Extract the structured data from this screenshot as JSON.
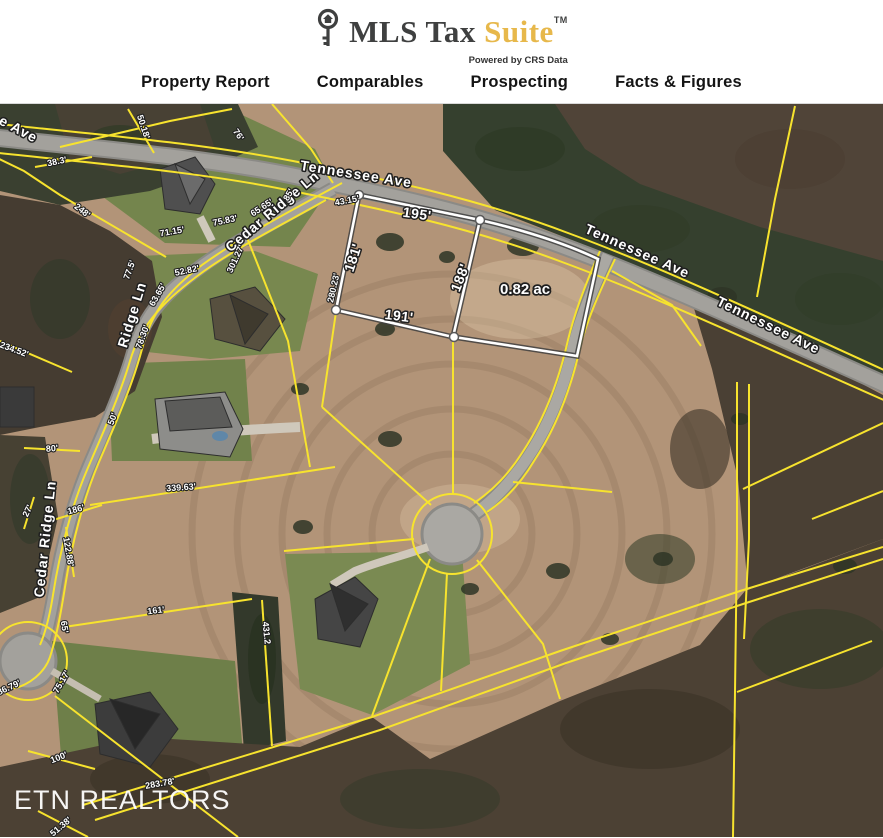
{
  "header": {
    "logo": {
      "icon": "key-icon",
      "title_dark": "MLS Tax",
      "title_gold": "Suite",
      "trademark": "TM",
      "tagline": "Powered by CRS Data",
      "gold_color": "#e7b84b",
      "dark_color": "#3f4040"
    },
    "nav": {
      "items": [
        {
          "label": "Property Report"
        },
        {
          "label": "Comparables"
        },
        {
          "label": "Prospecting"
        },
        {
          "label": "Facts & Figures"
        }
      ]
    }
  },
  "map": {
    "watermark": "ETN REALTORS",
    "colors": {
      "parcel_line": "#f7e32e",
      "selected_parcel_line": "#ffffff",
      "road": "#a3a19c",
      "field": "#b29478"
    },
    "street_labels": [
      {
        "text": "e Ave",
        "x": 18,
        "y": 131,
        "rot": 28,
        "size": 14
      },
      {
        "text": "Tennessee Ave",
        "x": 356,
        "y": 176,
        "rot": 9,
        "size": 15
      },
      {
        "text": "Tennessee Ave",
        "x": 637,
        "y": 253,
        "rot": 24,
        "size": 14
      },
      {
        "text": "Tennessee Ave",
        "x": 768,
        "y": 327,
        "rot": 26,
        "size": 14
      },
      {
        "text": "Cedar Ridge Ln",
        "x": 273,
        "y": 213,
        "rot": -40,
        "size": 14
      },
      {
        "text": "Ridge Ln",
        "x": 133,
        "y": 316,
        "rot": -73,
        "size": 14
      },
      {
        "text": "Cedar Ridge Ln",
        "x": 46,
        "y": 540,
        "rot": -84,
        "size": 14
      }
    ],
    "parcel_dims": [
      {
        "text": "195'",
        "x": 417,
        "y": 216,
        "rot": 8
      },
      {
        "text": "181'",
        "x": 354,
        "y": 259,
        "rot": -72
      },
      {
        "text": "188'",
        "x": 461,
        "y": 279,
        "rot": -69
      },
      {
        "text": "191'",
        "x": 399,
        "y": 318,
        "rot": 7
      }
    ],
    "area_label": {
      "text": "0.82 ac",
      "x": 525,
      "y": 291,
      "rot": 0
    },
    "dimension_labels": [
      {
        "text": "50.18'",
        "x": 143,
        "y": 128,
        "rot": 72
      },
      {
        "text": "76'",
        "x": 238,
        "y": 136,
        "rot": 55
      },
      {
        "text": "38.3'",
        "x": 57,
        "y": 163,
        "rot": -12
      },
      {
        "text": "248'",
        "x": 82,
        "y": 212,
        "rot": 38
      },
      {
        "text": "71.15'",
        "x": 172,
        "y": 233,
        "rot": -10
      },
      {
        "text": "75.83'",
        "x": 225,
        "y": 222,
        "rot": -12
      },
      {
        "text": "65.65'",
        "x": 262,
        "y": 209,
        "rot": -33
      },
      {
        "text": "85'",
        "x": 289,
        "y": 196,
        "rot": -60
      },
      {
        "text": "301.27'",
        "x": 236,
        "y": 260,
        "rot": -65
      },
      {
        "text": "52.82'",
        "x": 187,
        "y": 272,
        "rot": -12
      },
      {
        "text": "63.65'",
        "x": 158,
        "y": 296,
        "rot": -60
      },
      {
        "text": "77.5'",
        "x": 130,
        "y": 271,
        "rot": -70
      },
      {
        "text": "78.30'",
        "x": 143,
        "y": 338,
        "rot": -70
      },
      {
        "text": "43.15'",
        "x": 347,
        "y": 202,
        "rot": -11
      },
      {
        "text": "280.23'",
        "x": 334,
        "y": 289,
        "rot": -77
      },
      {
        "text": "234.52'",
        "x": 14,
        "y": 351,
        "rot": 20
      },
      {
        "text": "50'",
        "x": 113,
        "y": 420,
        "rot": -70
      },
      {
        "text": "80'",
        "x": 52,
        "y": 450,
        "rot": -5
      },
      {
        "text": "339.63'",
        "x": 181,
        "y": 489,
        "rot": -4
      },
      {
        "text": "27'",
        "x": 28,
        "y": 512,
        "rot": -65
      },
      {
        "text": "186'",
        "x": 76,
        "y": 511,
        "rot": -15
      },
      {
        "text": "122.88'",
        "x": 68,
        "y": 553,
        "rot": 80
      },
      {
        "text": "65'",
        "x": 64,
        "y": 628,
        "rot": 82
      },
      {
        "text": "161'",
        "x": 156,
        "y": 612,
        "rot": -7
      },
      {
        "text": "431.2",
        "x": 266,
        "y": 634,
        "rot": 84
      },
      {
        "text": "75.17'",
        "x": 62,
        "y": 683,
        "rot": -60
      },
      {
        "text": "86.79'",
        "x": 9,
        "y": 689,
        "rot": -25
      },
      {
        "text": "100'",
        "x": 59,
        "y": 759,
        "rot": -22
      },
      {
        "text": "283.78'",
        "x": 160,
        "y": 785,
        "rot": -10
      },
      {
        "text": "51.38'",
        "x": 61,
        "y": 828,
        "rot": -40
      }
    ]
  }
}
